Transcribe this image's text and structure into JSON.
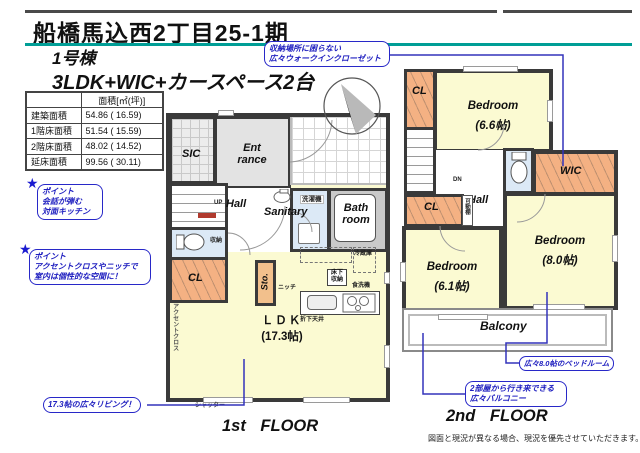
{
  "header": {
    "title": "船橋馬込西2丁目25-1期",
    "building": "1号棟",
    "plan": "3LDK+WIC+カースペース2台"
  },
  "area_table": {
    "col_header": "面積[㎡(坪)]",
    "rows": [
      {
        "label": "建築面積",
        "value": "54.86 ( 16.59)"
      },
      {
        "label": "1階床面積",
        "value": "51.54 ( 15.59)"
      },
      {
        "label": "2階床面積",
        "value": "48.02 ( 14.52)"
      },
      {
        "label": "延床面積",
        "value": "99.56 ( 30.11)"
      }
    ]
  },
  "callouts": {
    "wic_line1": "収納場所に困らない",
    "wic_line2": "広々ウォークインクローゼット",
    "point1_title": "ポイント",
    "point1_line1": "会話が弾む",
    "point1_line2": "対面キッチン",
    "point2_title": "ポイント",
    "point2_line1": "アクセントクロスやニッチで",
    "point2_line2": "室内は個性的な空間に！",
    "living": "17.3帖の広々リビング！",
    "bedroom8": "広々8.0帖のベッドルーム",
    "balcony_line1": "2部屋から行き来できる",
    "balcony_line2": "広々バルコニー"
  },
  "floor1": {
    "caption": "1st FLOOR",
    "rooms": {
      "sic": "SIC",
      "entrance_l1": "Ent",
      "entrance_l2": "rance",
      "up": "UP",
      "hall": "Hall",
      "sanitary": "Sanitary",
      "bath_l1": "Bath",
      "bath_l2": "room",
      "cl": "CL",
      "sto": "Sto.",
      "ldk_l1": "ＬＤＫ",
      "ldk_l2": "(17.3帖)"
    },
    "labels": {
      "washer": "洗濯機",
      "storage": "収納",
      "niche": "ニッチ",
      "fridge": "冷蔵庫",
      "floor_storage_l1": "床下",
      "floor_storage_l2": "収納",
      "dishwasher": "食洗機",
      "ceiling": "折下天井",
      "accent_cloth": "アクセントクロス",
      "shutter": "シャッター"
    }
  },
  "floor2": {
    "caption": "2nd FLOOR",
    "rooms": {
      "cl_top": "CL",
      "bedroom66_l1": "Bedroom",
      "bedroom66_l2": "(6.6帖)",
      "wic": "WIC",
      "hall": "Hall",
      "cl_mid": "CL",
      "bedroom61_l1": "Bedroom",
      "bedroom61_l2": "(6.1帖)",
      "bedroom80_l1": "Bedroom",
      "bedroom80_l2": "(8.0帖)",
      "balcony": "Balcony"
    },
    "labels": {
      "dn": "DN",
      "movable_shelf": "可動棚"
    }
  },
  "footer": {
    "disclaimer": "図面と現況が異なる場合、現況を優先させていただきます。"
  },
  "colors": {
    "accent_teal": "#009E96",
    "callout_blue": "#2828C8",
    "wall": "#3A3A3A",
    "room_yellow": "#FBFAD2",
    "closet_orange": "#F4B183",
    "wet_blue": "#DCE9F6",
    "bath_gray": "#C9C9C9",
    "stair_mark_red": "#B03A2E"
  }
}
